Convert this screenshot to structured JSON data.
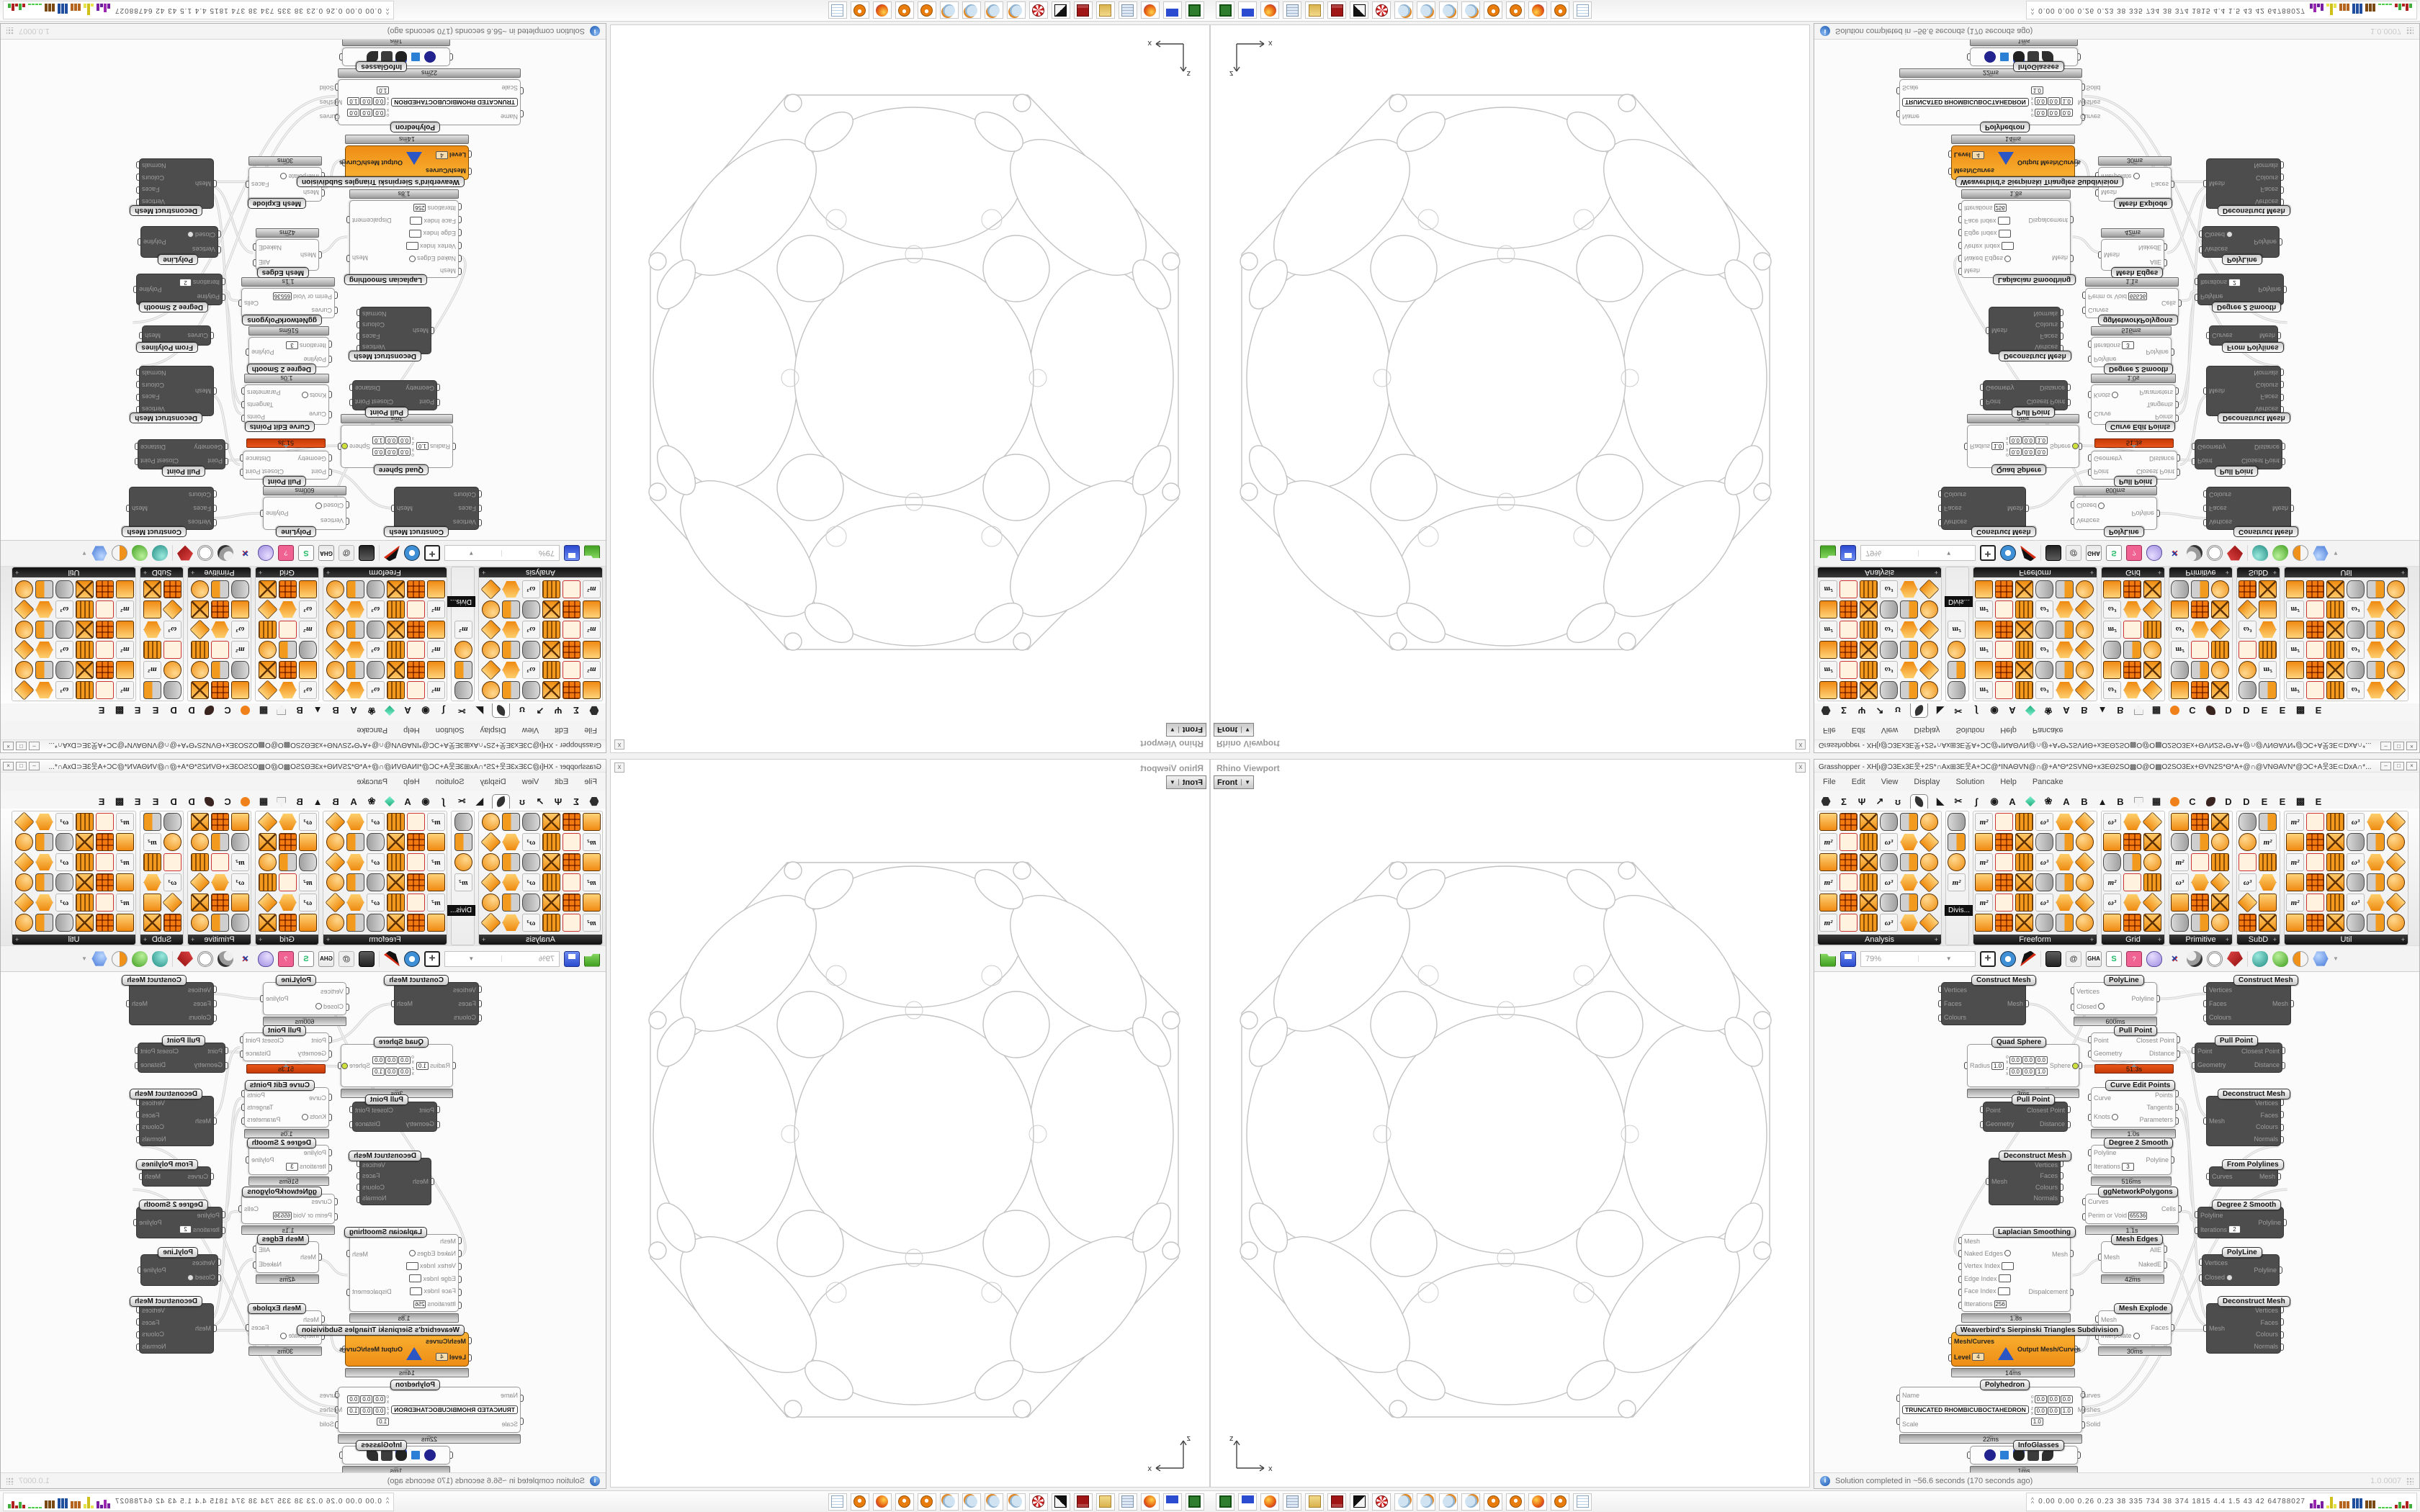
{
  "viewport": {
    "title": "Rhino Viewport",
    "close_label": "x",
    "view_label": "Front",
    "dropdown_glyph": "▼",
    "axis": {
      "vertical": "z",
      "horizontal": "x"
    }
  },
  "gh": {
    "title": "Grasshopper - XH[ι@Ɔ3Ex3E웃+2S*∩Ax⊞3E웃A+ƆC@*INAΘVN@∩@+A*Θ*2SVNΘ+x3EΘ2SO▩O@O▩O2SO3Ex+ΘVN2S*Θ*A+@∩@VNΘAVN*@ƆC+A웃3E⊂DxA∩*...",
    "window_buttons": [
      "–",
      "□",
      "×"
    ],
    "menus": [
      "File",
      "Edit",
      "View",
      "Display",
      "Solution",
      "Help",
      "Pancake"
    ],
    "tabs": [
      {
        "shape": "hex"
      },
      {
        "t": "Σ"
      },
      {
        "t": "Ψ"
      },
      {
        "t": "↗"
      },
      {
        "t": "ʊ"
      },
      {
        "shape": "leaf",
        "active": true
      },
      {
        "t": "◣"
      },
      {
        "t": "✂"
      },
      {
        "t": "ʃ"
      },
      {
        "t": "◉"
      },
      {
        "t": "A"
      },
      {
        "shape": "gem"
      },
      {
        "t": "❀"
      },
      {
        "t": "A"
      },
      {
        "t": "B"
      },
      {
        "t": "▲"
      },
      {
        "t": "B"
      },
      {
        "shape": "shield"
      },
      {
        "t": "▦"
      },
      {
        "shape": "dot"
      },
      {
        "t": "C"
      },
      {
        "shape": "bird"
      },
      {
        "t": "D"
      },
      {
        "t": "D"
      },
      {
        "t": "E"
      },
      {
        "t": "E"
      },
      {
        "t": "▩"
      },
      {
        "t": "E"
      }
    ],
    "ribbon": {
      "divis_label": "Divis...",
      "groups": [
        {
          "name": "Analysis",
          "cols": 6,
          "rows": 6
        },
        {
          "name": "Division",
          "cols": 1,
          "rows": 4,
          "narrow": true
        },
        {
          "name": "Freeform",
          "cols": 6,
          "rows": 6
        },
        {
          "name": "Grid",
          "cols": 3,
          "rows": 6
        },
        {
          "name": "Primitive",
          "cols": 3,
          "rows": 6
        },
        {
          "name": "SubD",
          "cols": 2,
          "rows": 6
        },
        {
          "name": "Util",
          "cols": 6,
          "rows": 6
        }
      ]
    },
    "toolbar": {
      "zoom_value": "79%",
      "icons": [
        "open",
        "save",
        "zoom-extents",
        "preview-eye",
        "sketch-pen",
        "sep",
        "preview-box",
        "at-link",
        "gha-assembly",
        "find-s",
        "help-pink",
        "remote-balloon",
        "cross-wires",
        "cluster-spheres",
        "rings",
        "gem-red",
        "sep",
        "blob-teal",
        "blob-green",
        "ball-half",
        "ball-blue",
        "arrow"
      ]
    },
    "status": {
      "text": "Solution completed in ~56.6 seconds (170 seconds ago)",
      "version": "1.0.0007"
    },
    "canvas": {
      "nodes": [
        {
          "label": "Construct Mesh",
          "cap": [
            218,
            4
          ],
          "box": [
            176,
            14,
            118,
            60
          ],
          "kind": "dark",
          "in": [
            {
              "t": "Vertices"
            },
            {
              "t": "Faces"
            },
            {
              "t": "Colours"
            }
          ],
          "out": [
            {
              "t": "Mesh"
            }
          ]
        },
        {
          "label": "PolyLine",
          "cap": [
            402,
            4
          ],
          "box": [
            360,
            14,
            116,
            46
          ],
          "kind": "light",
          "in": [
            {
              "t": "Vertices"
            },
            {
              "t": "Closed",
              "port": "circle"
            }
          ],
          "out": [
            {
              "t": "Polyline"
            }
          ],
          "timer": "600ms",
          "tbox": [
            360,
            62,
            116
          ]
        },
        {
          "label": "Construct Mesh",
          "cap": [
            582,
            4
          ],
          "box": [
            544,
            14,
            118,
            60
          ],
          "kind": "dark",
          "in": [
            {
              "t": "Vertices"
            },
            {
              "t": "Faces"
            },
            {
              "t": "Colours"
            }
          ],
          "out": [
            {
              "t": "Mesh"
            }
          ]
        },
        {
          "label": "Quad Sphere",
          "cap": [
            246,
            90
          ],
          "box": [
            212,
            100,
            156,
            60
          ],
          "kind": "light",
          "planeLabel": "Base",
          "plane": {
            "l1": "o x",
            "r1": [
              "0.0",
              "0.0",
              "0.0"
            ],
            "l2": "z x",
            "r2": [
              "0.0",
              "0.0",
              "1.0"
            ]
          },
          "in": [
            {
              "t": "Radius",
              "box": "1.0"
            }
          ],
          "out": [
            {
              "t": "Sphere",
              "dot": "#cfe03a"
            }
          ],
          "timer": "3ms",
          "tbox": [
            212,
            162,
            156
          ]
        },
        {
          "label": "Pull Point",
          "cap": [
            416,
            74
          ],
          "box": [
            384,
            84,
            120,
            40
          ],
          "kind": "light",
          "in": [
            {
              "t": "Point"
            },
            {
              "t": "Geometry"
            }
          ],
          "out": [
            {
              "t": "Closest Point"
            },
            {
              "t": "Distance"
            }
          ],
          "timer": "51.3s",
          "red": true,
          "tbox": [
            389,
            128,
            110
          ]
        },
        {
          "label": "Pull Point",
          "cap": [
            556,
            88
          ],
          "box": [
            528,
            98,
            122,
            42
          ],
          "kind": "dark",
          "in": [
            {
              "t": "Point"
            },
            {
              "t": "Geometry"
            }
          ],
          "out": [
            {
              "t": "Closest Point"
            },
            {
              "t": "Distance"
            }
          ]
        },
        {
          "label": "Curve Edit Points",
          "cap": [
            404,
            150
          ],
          "box": [
            384,
            160,
            118,
            56
          ],
          "kind": "light",
          "in": [
            {
              "t": "Curve"
            },
            {
              "t": "Knots",
              "port": "circle"
            }
          ],
          "out": [
            {
              "t": "Points"
            },
            {
              "t": "Tangents"
            },
            {
              "t": "Parameters"
            }
          ],
          "timer": "1.0s",
          "tbox": [
            384,
            218,
            118
          ]
        },
        {
          "label": "Pull Point",
          "cap": [
            274,
            170
          ],
          "box": [
            234,
            180,
            118,
            42
          ],
          "kind": "dark",
          "in": [
            {
              "t": "Point"
            },
            {
              "t": "Geometry"
            }
          ],
          "out": [
            {
              "t": "Closest Point"
            },
            {
              "t": "Distance"
            }
          ]
        },
        {
          "label": "Deconstruct Mesh",
          "cap": [
            560,
            162
          ],
          "box": [
            544,
            172,
            104,
            70
          ],
          "kind": "dark",
          "in": [
            {
              "t": "Mesh"
            }
          ],
          "out": [
            {
              "t": "Vertices"
            },
            {
              "t": "Faces"
            },
            {
              "t": "Colours"
            },
            {
              "t": "Normals"
            }
          ]
        },
        {
          "label": "Deconstruct Mesh",
          "cap": [
            256,
            248
          ],
          "box": [
            242,
            258,
            100,
            66
          ],
          "kind": "dark",
          "in": [
            {
              "t": "Mesh"
            }
          ],
          "out": [
            {
              "t": "Vertices"
            },
            {
              "t": "Faces"
            },
            {
              "t": "Colours"
            },
            {
              "t": "Normals"
            }
          ]
        },
        {
          "label": "Degree 2 Smooth",
          "cap": [
            402,
            230
          ],
          "box": [
            384,
            240,
            112,
            42
          ],
          "kind": "light",
          "in": [
            {
              "t": "Polyline"
            },
            {
              "t": "Iterations",
              "box": "3"
            }
          ],
          "out": [
            {
              "t": "Polyline"
            }
          ],
          "timer": "516ms",
          "tbox": [
            384,
            284,
            112
          ]
        },
        {
          "label": "From Polylines",
          "cap": [
            566,
            260
          ],
          "box": [
            548,
            270,
            96,
            28
          ],
          "kind": "dark",
          "in": [
            {
              "t": "Curves"
            }
          ],
          "out": [
            {
              "t": "Mesh"
            }
          ]
        },
        {
          "label": "ggNetworkPolygons",
          "cap": [
            394,
            298
          ],
          "box": [
            376,
            308,
            130,
            42
          ],
          "kind": "light",
          "in": [
            {
              "t": "Curves"
            },
            {
              "t": "Perim or Void",
              "box": "65536"
            }
          ],
          "out": [
            {
              "t": "Cells"
            }
          ],
          "timer": "1.1s",
          "tbox": [
            376,
            352,
            130
          ]
        },
        {
          "label": "Degree 2 Smooth",
          "cap": [
            552,
            316
          ],
          "box": [
            532,
            326,
            120,
            44
          ],
          "kind": "dark",
          "in": [
            {
              "t": "Polyline"
            },
            {
              "t": "Iterations",
              "box": "2"
            }
          ],
          "out": [
            {
              "t": "Polyline"
            }
          ]
        },
        {
          "label": "Mesh Edges",
          "cap": [
            412,
            364
          ],
          "box": [
            398,
            374,
            88,
            44
          ],
          "kind": "light",
          "in": [
            {
              "t": "Mesh"
            }
          ],
          "out": [
            {
              "t": "AllE"
            },
            {
              "t": "NakedE"
            }
          ],
          "timer": "42ms",
          "tbox": [
            398,
            420,
            88
          ]
        },
        {
          "label": "PolyLine",
          "cap": [
            566,
            382
          ],
          "box": [
            538,
            392,
            108,
            44
          ],
          "kind": "dark",
          "in": [
            {
              "t": "Vertices"
            },
            {
              "t": "Closed",
              "port": "dot"
            }
          ],
          "out": [
            {
              "t": "Polyline"
            }
          ]
        },
        {
          "label": "Laplacian Smoothing",
          "cap": [
            248,
            354
          ],
          "box": [
            204,
            364,
            152,
            108
          ],
          "kind": "light",
          "in": [
            {
              "t": "Mesh"
            },
            {
              "t": "Naked Edges",
              "port": "circle"
            },
            {
              "t": "Vertex Index",
              "box": " "
            },
            {
              "t": "Edge Index",
              "box": " "
            },
            {
              "t": "Face Index",
              "box": " "
            },
            {
              "t": "Itterations",
              "box": "256"
            }
          ],
          "out": [
            {
              "t": "Mesh"
            },
            {
              "t": "Dispalcement"
            }
          ],
          "timer": "1.8s",
          "tbox": [
            204,
            474,
            152
          ]
        },
        {
          "label": "Mesh Explode",
          "cap": [
            416,
            460
          ],
          "box": [
            394,
            470,
            102,
            48
          ],
          "kind": "light",
          "in": [
            {
              "t": "Mesh"
            },
            {
              "t": "Interpolate",
              "port": "circle"
            }
          ],
          "out": [
            {
              "t": "Faces"
            }
          ],
          "timer": "30ms",
          "tbox": [
            394,
            520,
            102
          ]
        },
        {
          "label": "Deconstruct Mesh",
          "cap": [
            560,
            450
          ],
          "box": [
            544,
            460,
            104,
            70
          ],
          "kind": "dark",
          "in": [
            {
              "t": "Mesh"
            }
          ],
          "out": [
            {
              "t": "Vertices"
            },
            {
              "t": "Faces"
            },
            {
              "t": "Colours"
            },
            {
              "t": "Normals"
            }
          ]
        },
        {
          "label": "Weaverbird's Sierpinski Triangles Subdivision",
          "cap": [
            196,
            490
          ],
          "box": [
            190,
            500,
            172,
            48
          ],
          "kind": "orange",
          "in": [
            {
              "t": "Mesh/Curves"
            },
            {
              "t": "Level",
              "box": "4",
              "beige": true
            }
          ],
          "out": [
            {
              "t": "Output Mesh/Curves"
            }
          ],
          "icon": "wtri",
          "timer": "14ms",
          "tbox": [
            190,
            550,
            172
          ]
        },
        {
          "label": "Polyhedron",
          "cap": [
            230,
            566
          ],
          "box": [
            118,
            576,
            254,
            64
          ],
          "kind": "light",
          "namebox": "TRUNCATED RHOMBICUBOCTAHEDRON",
          "plane": {
            "l1": "o x",
            "r1": [
              "0.0",
              "0.0",
              "0.0"
            ],
            "l2": "z x",
            "r2": [
              "0.0",
              "0.0",
              "1.0"
            ]
          },
          "planeLabel": "Plane",
          "scalebox": "1.0",
          "in": [
            {
              "t": "Name"
            },
            {
              "t": "Scale"
            }
          ],
          "out": [
            {
              "t": "Curves"
            },
            {
              "t": "Meshes"
            },
            {
              "t": "Solid"
            }
          ],
          "icon": "ball",
          "timer": "22ms",
          "tbox": [
            118,
            642,
            254
          ]
        },
        {
          "label": "InfoGlasses",
          "cap": [
            276,
            650
          ],
          "box": [
            216,
            658,
            150,
            26
          ],
          "kind": "light",
          "icons5": true,
          "in": [],
          "out": [],
          "timer": "1ms",
          "tbox": [
            216,
            686,
            150
          ]
        }
      ],
      "wires": [
        [
          294,
          44,
          384,
          96
        ],
        [
          476,
          37,
          544,
          30
        ],
        [
          368,
          130,
          528,
          110
        ],
        [
          504,
          104,
          544,
          200
        ],
        [
          502,
          174,
          532,
          340
        ],
        [
          502,
          188,
          544,
          478
        ],
        [
          356,
          418,
          398,
          396
        ],
        [
          486,
          396,
          544,
          488
        ],
        [
          496,
          494,
          544,
          494
        ],
        [
          362,
          524,
          394,
          484
        ],
        [
          372,
          600,
          640,
          240
        ],
        [
          372,
          612,
          652,
          300
        ],
        [
          360,
          44,
          206,
          392
        ],
        [
          506,
          330,
          532,
          344
        ]
      ]
    }
  },
  "taskbar": {
    "icons": [
      "terminal-green",
      "floppy-64",
      "firefox",
      "calculator",
      "folder",
      "package-red",
      "inkscape",
      "badge-red",
      "palette",
      "palette",
      "palette",
      "palette",
      "blender",
      "blender",
      "firefox",
      "blender",
      "notepad"
    ],
    "tray": {
      "chevron": "^",
      "stats": "0.00 0.00 0.26 0.23  38  335  734  38  374 1815 4.4  1.5  43  42  64788027",
      "charts": [
        "spark-purple",
        "spark-yellow",
        "bar-orange",
        "bar-blue",
        "bar-brown",
        "line-green",
        "jag-red"
      ]
    }
  }
}
